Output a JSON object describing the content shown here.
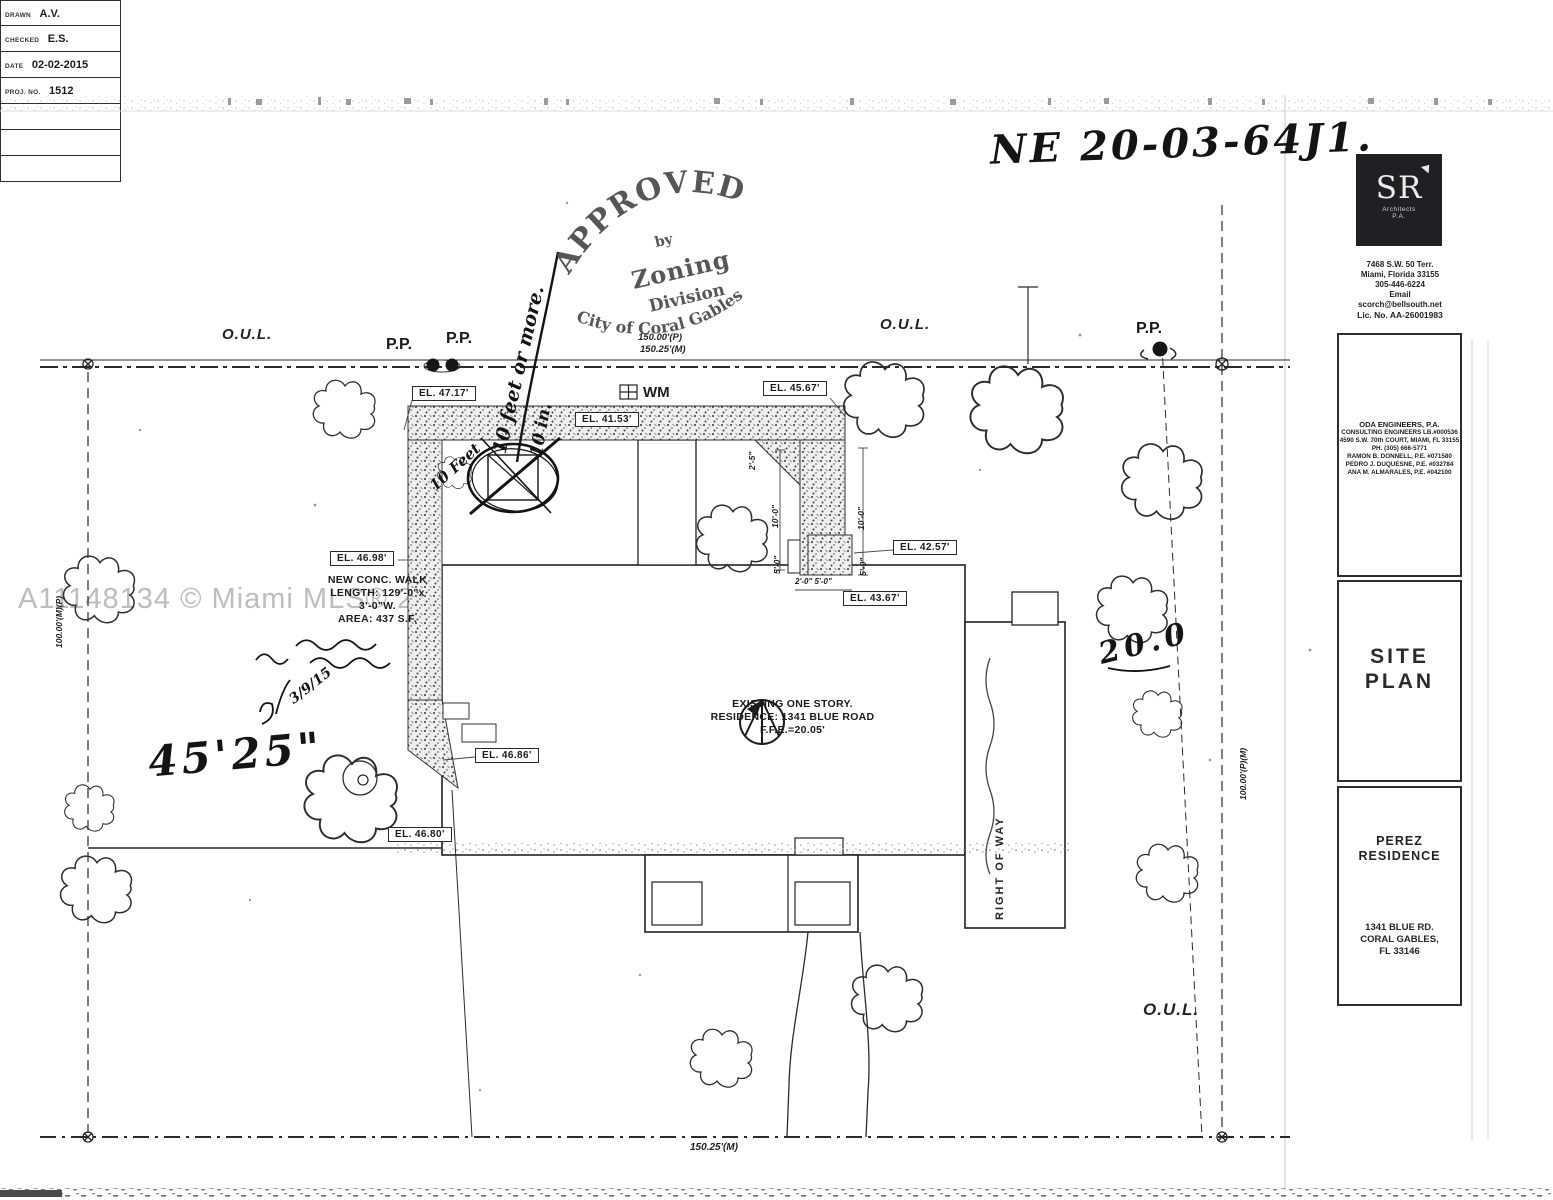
{
  "ink_color": "#1c1c1c",
  "scan": {
    "watermark": "A11148134 © Miami MLS® 2022"
  },
  "handwriting": {
    "permit_number": "NE 20-03-64J1.",
    "dim_left": "45'25\"",
    "dim_right": "20.0",
    "walk_width_note": "10 Feet",
    "setback_note": "10 feet or more.",
    "min_note": "10 in.",
    "date_note": "3/9/15"
  },
  "stamp": {
    "approved": "APPROVED",
    "by": "by",
    "zoning": "Zoning",
    "division": "Division",
    "city": "City of Coral Gables"
  },
  "plan": {
    "oul_left": "O.U.L.",
    "oul_right": "O.U.L.",
    "oul_bottom": "O.U.L.",
    "pp_1": "P.P.",
    "pp_2": "P.P.",
    "pp_3": "P.P.",
    "dim_top_plat": "150.00'(P)",
    "dim_top_measured": "150.25'(M)",
    "dim_bottom": "150.25'(M)",
    "dim_left_side": "100.00'(M)(P)",
    "dim_right_side": "100.00'(P)(M)",
    "water_meter": "WM",
    "right_of_way": "RIGHT OF WAY",
    "elevations": {
      "el_1": "EL. 47.17'",
      "el_2": "EL. 41.53'",
      "el_3": "EL. 45.67'",
      "el_4": "EL. 46.98'",
      "el_5": "EL. 42.57'",
      "el_6": "EL. 43.67'",
      "el_7": "EL. 46.86'",
      "el_8": "EL. 46.80'"
    },
    "dims": {
      "d_2_5": "2'-5\"",
      "d_10_0_a": "10'-0\"",
      "d_10_0_b": "10'-0\"",
      "d_5_0_a": "5'-0\"",
      "d_5_0_b": "5'-0\"",
      "d_2_0_5_0": "2'-0\" 5'-0\""
    },
    "walk_note": [
      "NEW CONC. WALK",
      "LENGTH: 129'-0\"x",
      "3'-0\"W.",
      "AREA: 437 S.F."
    ],
    "residence_note": [
      "EXISTING ONE STORY.",
      "RESIDENCE: 1341 BLUE ROAD",
      "F.F.E.=20.05'"
    ]
  },
  "title_block": {
    "logo_initials": "SR",
    "logo_sub1": "Architects",
    "logo_sub2": "P.A.",
    "address": [
      "7468 S.W. 50 Terr.",
      "Miami, Florida 33155",
      "305-446-6224",
      "Email",
      "scorch@bellsouth.net",
      "Lic. No. AA-26001983"
    ],
    "engineer": [
      "ODA ENGINEERS, P.A.",
      "CONSULTING ENGINEERS LB.#000536",
      "4590 S.W. 70th COURT, MIAMI, FL 33155",
      "PH. (305) 666-5771",
      "RAMON B. DONNELL, P.E. #071580",
      "PEDRO J. DUQUESNE, P.E. #032784",
      "ANA M. ALMARALES, P.E. #042100"
    ],
    "sheet_title_1": "SITE",
    "sheet_title_2": "PLAN",
    "project_1": "PEREZ",
    "project_2": "RESIDENCE",
    "project_address": [
      "1341 BLUE RD.",
      "CORAL GABLES,",
      "FL 33146"
    ],
    "rows": [
      {
        "label": "DRAWN",
        "value": "A.V."
      },
      {
        "label": "CHECKED",
        "value": "E.S."
      },
      {
        "label": "DATE",
        "value": "02-02-2015"
      },
      {
        "label": "PROJ. NO.",
        "value": "1512"
      }
    ]
  }
}
